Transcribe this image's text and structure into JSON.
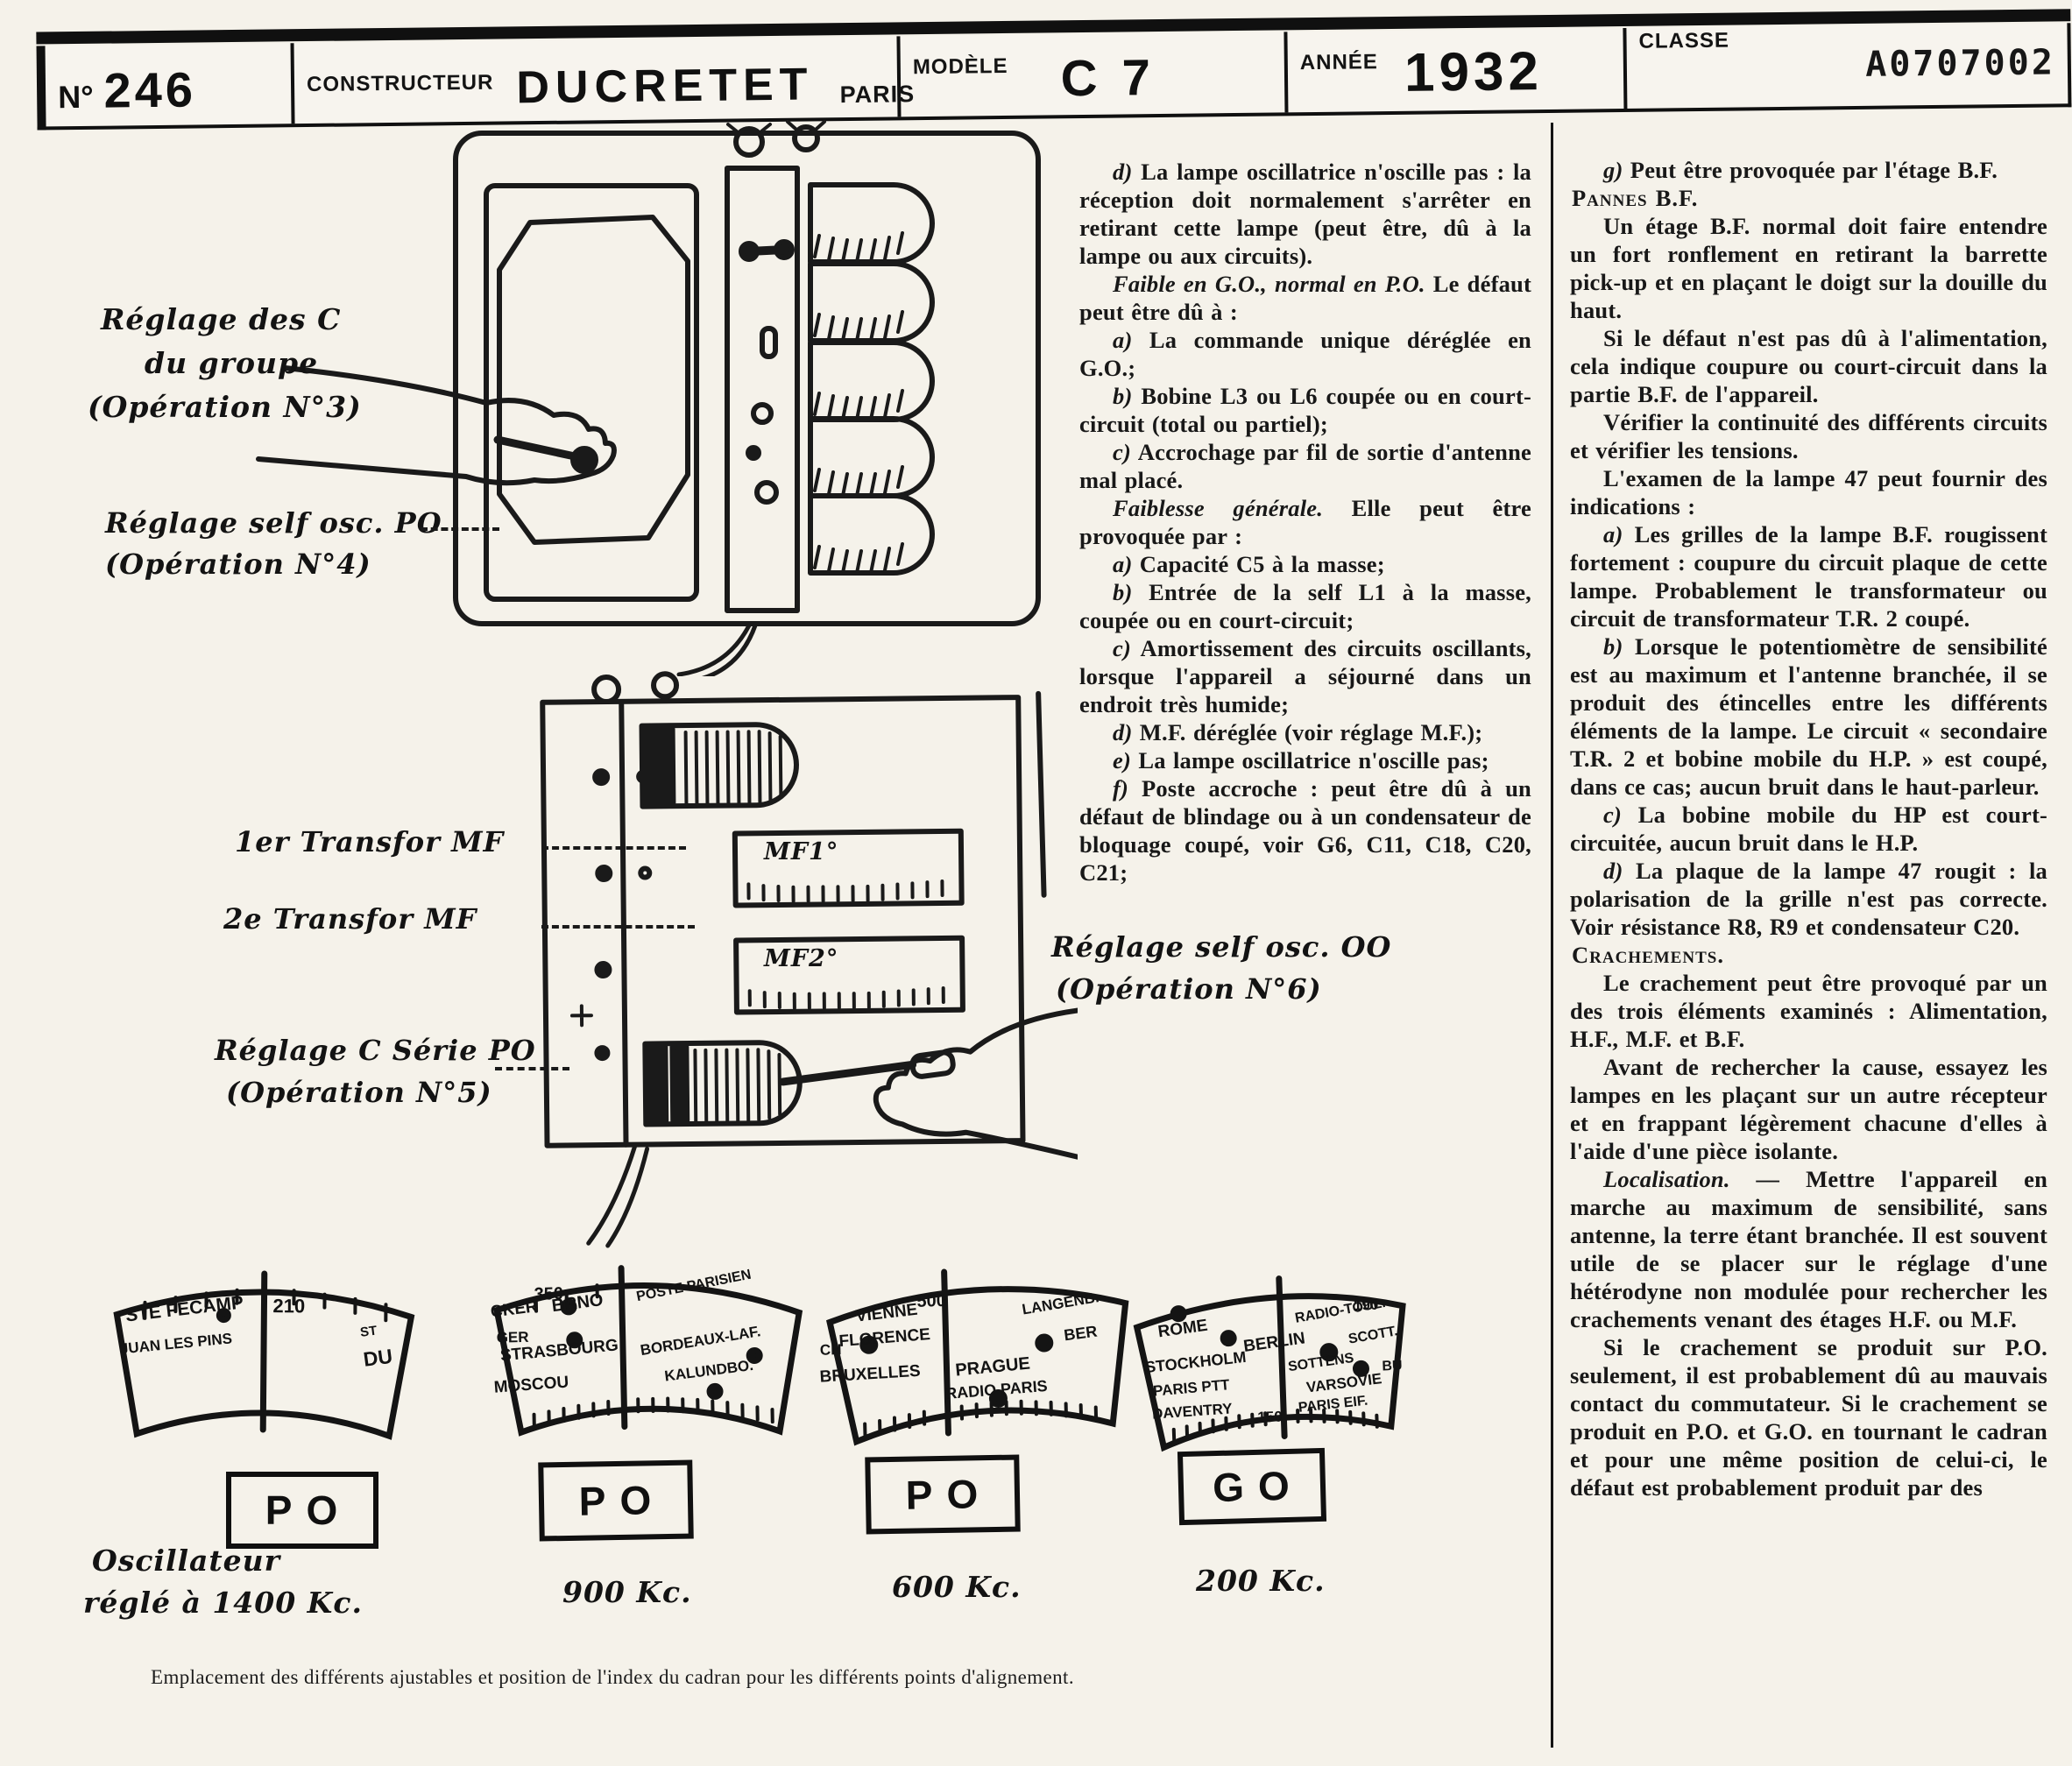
{
  "header": {
    "no_label": "N°",
    "no_value": "246",
    "constructeur_label": "CONSTRUCTEUR",
    "constructeur_value": "DUCRETET",
    "city": "PARIS",
    "modele_label": "MODÈLE",
    "modele_value": "C 7",
    "annee_label": "ANNÉE",
    "annee_value": "1932",
    "classe_label": "CLASSE",
    "classe_value": "A0707002"
  },
  "annotations": {
    "a1_line1": "Réglage des C",
    "a1_line2": "du groupe",
    "a1_line3": "(Opération N°3)",
    "a2_line1": "Réglage self osc. PO",
    "a2_line2": "(Opération N°4)",
    "a3": "1er Transfor MF",
    "a4": "2e Transfor MF",
    "a5_line1": "Réglage C  Série PO",
    "a5_line2": "(Opération N°5)",
    "a6_line1": "Réglage self osc. OO",
    "a6_line2": "(Opération N°6)",
    "mf1": "MF1°",
    "mf2": "MF2°"
  },
  "col1": {
    "paragraphs": [
      {
        "l": "d)",
        "t": " La lampe oscillatrice n'oscille pas : la réception doit normalement s'arrêter en retirant cette lampe (peut être, dû à la lampe ou aux circuits)."
      },
      {
        "l": "Faible en G.O., normal en P.O.",
        "t": " Le défaut peut être dû à :"
      },
      {
        "l": "a)",
        "t": " La commande unique déréglée en G.O.;"
      },
      {
        "l": "b)",
        "t": " Bobine L3 ou L6 coupée ou en court-circuit (total ou partiel);"
      },
      {
        "l": "c)",
        "t": " Accrochage par fil de sortie d'antenne mal placé."
      },
      {
        "l": "Faiblesse générale.",
        "t": " Elle peut être provoquée par :"
      },
      {
        "l": "a)",
        "t": " Capacité C5 à la masse;"
      },
      {
        "l": "b)",
        "t": " Entrée de la self L1 à la masse, coupée ou en court-circuit;"
      },
      {
        "l": "c)",
        "t": " Amortissement des circuits oscillants, lorsque l'appareil a séjourné dans un endroit très humide;"
      },
      {
        "l": "d)",
        "t": " M.F. déréglée (voir réglage M.F.);"
      },
      {
        "l": "e)",
        "t": " La lampe oscillatrice n'oscille pas;"
      },
      {
        "l": "f)",
        "t": " Poste accroche : peut être dû à un défaut de blindage ou à un condensateur de bloquage coupé, voir G6, C11, C18, C20, C21;"
      }
    ]
  },
  "col2": {
    "paragraphs": [
      {
        "l": "g)",
        "t": " Peut être provoquée par l'étage B.F."
      },
      {
        "l": "",
        "t": "Pannes B.F."
      },
      {
        "l": "",
        "t": "Un étage B.F. normal doit faire entendre un fort ronflement en retirant la barrette pick-up et en plaçant le doigt sur la douille du haut."
      },
      {
        "l": "",
        "t": "Si le défaut n'est pas dû à l'alimentation, cela indique coupure ou court-circuit dans la partie B.F. de l'appareil."
      },
      {
        "l": "",
        "t": "Vérifier la continuité des différents circuits et vérifier les tensions."
      },
      {
        "l": "",
        "t": "L'examen de la lampe 47 peut fournir des indications :"
      },
      {
        "l": "a)",
        "t": " Les grilles de la lampe B.F. rougissent fortement : coupure du circuit plaque de cette lampe. Probablement le transformateur ou circuit de transformateur T.R. 2 coupé."
      },
      {
        "l": "b)",
        "t": " Lorsque le potentiomètre de sensibilité est au maximum et l'antenne branchée, il se produit des étincelles entre les différents éléments de la lampe. Le circuit « secondaire T.R. 2 et bobine mobile du H.P. » est coupé, dans ce cas; aucun bruit dans le haut-parleur."
      },
      {
        "l": "c)",
        "t": " La bobine mobile du HP est court-circuitée, aucun bruit dans le H.P."
      },
      {
        "l": "d)",
        "t": " La plaque de la lampe 47 rougit : la polarisation de la grille n'est pas correcte. Voir résistance R8, R9 et condensateur C20."
      },
      {
        "l": "",
        "t": "Crachements."
      },
      {
        "l": "",
        "t": "Le crachement peut être provoqué par un des trois éléments examinés : Alimentation, H.F., M.F. et B.F."
      },
      {
        "l": "",
        "t": "Avant de rechercher la cause, essayez les lampes en les plaçant sur un autre récepteur et en frappant légèrement chacune d'elles à l'aide d'une pièce isolante."
      },
      {
        "l": "Localisation. —",
        "t": " Mettre l'appareil en marche au maximum de sensibilité, sans antenne, la terre étant branchée. Il est souvent utile de se placer sur le réglage d'une hétérodyne non modulée pour rechercher les crachements venant des étages H.F. ou M.F."
      },
      {
        "l": "",
        "t": "Si le crachement se produit sur P.O. seulement, il est probablement dû au mauvais contact du commutateur. Si le crachement se produit en P.O. et G.O. en tournant le cadran et pour une même position de celui-ci, le défaut est probablement produit par des"
      }
    ]
  },
  "dials": [
    {
      "band": "PO",
      "number": "210",
      "stations": [
        "STE FECAMP",
        "JUAN LES PINS",
        "ST",
        "DU"
      ]
    },
    {
      "band": "PO",
      "number": "350",
      "stations": [
        "CKER",
        "BRNO",
        "GER",
        "STRASBOURG",
        "MOSCOU",
        "POSTE PARISIEN",
        "BORDEAUX-LAF.",
        "KALUNDBO."
      ]
    },
    {
      "band": "PO",
      "number": "500",
      "stations": [
        "CH",
        "VIENNE",
        "FLORENCE",
        "BRUXELLES",
        "LANGENB.",
        "BER",
        "PRAGUE",
        "RADIO PARIS"
      ]
    },
    {
      "band": "GO",
      "number": "190",
      "number2": "150",
      "stations": [
        "ROME",
        "RADIO-TOUL.",
        "BERLIN",
        "SCOTT.",
        "STOCKHOLM",
        "SOTTENS",
        "BU",
        "VARSOVIE",
        "PARIS PTT",
        "DAVENTRY",
        "PARIS EIF."
      ]
    }
  ],
  "freq_labels": {
    "d1_line1": "Oscillateur",
    "d1_line2": "réglé  à  1400 Kc.",
    "d2": "900 Kc.",
    "d3": "600 Kc.",
    "d4": "200 Kc."
  },
  "footer": {
    "caption": "Emplacement des différents ajustables et position de l'index du cadran pour les différents points d'alignement."
  }
}
